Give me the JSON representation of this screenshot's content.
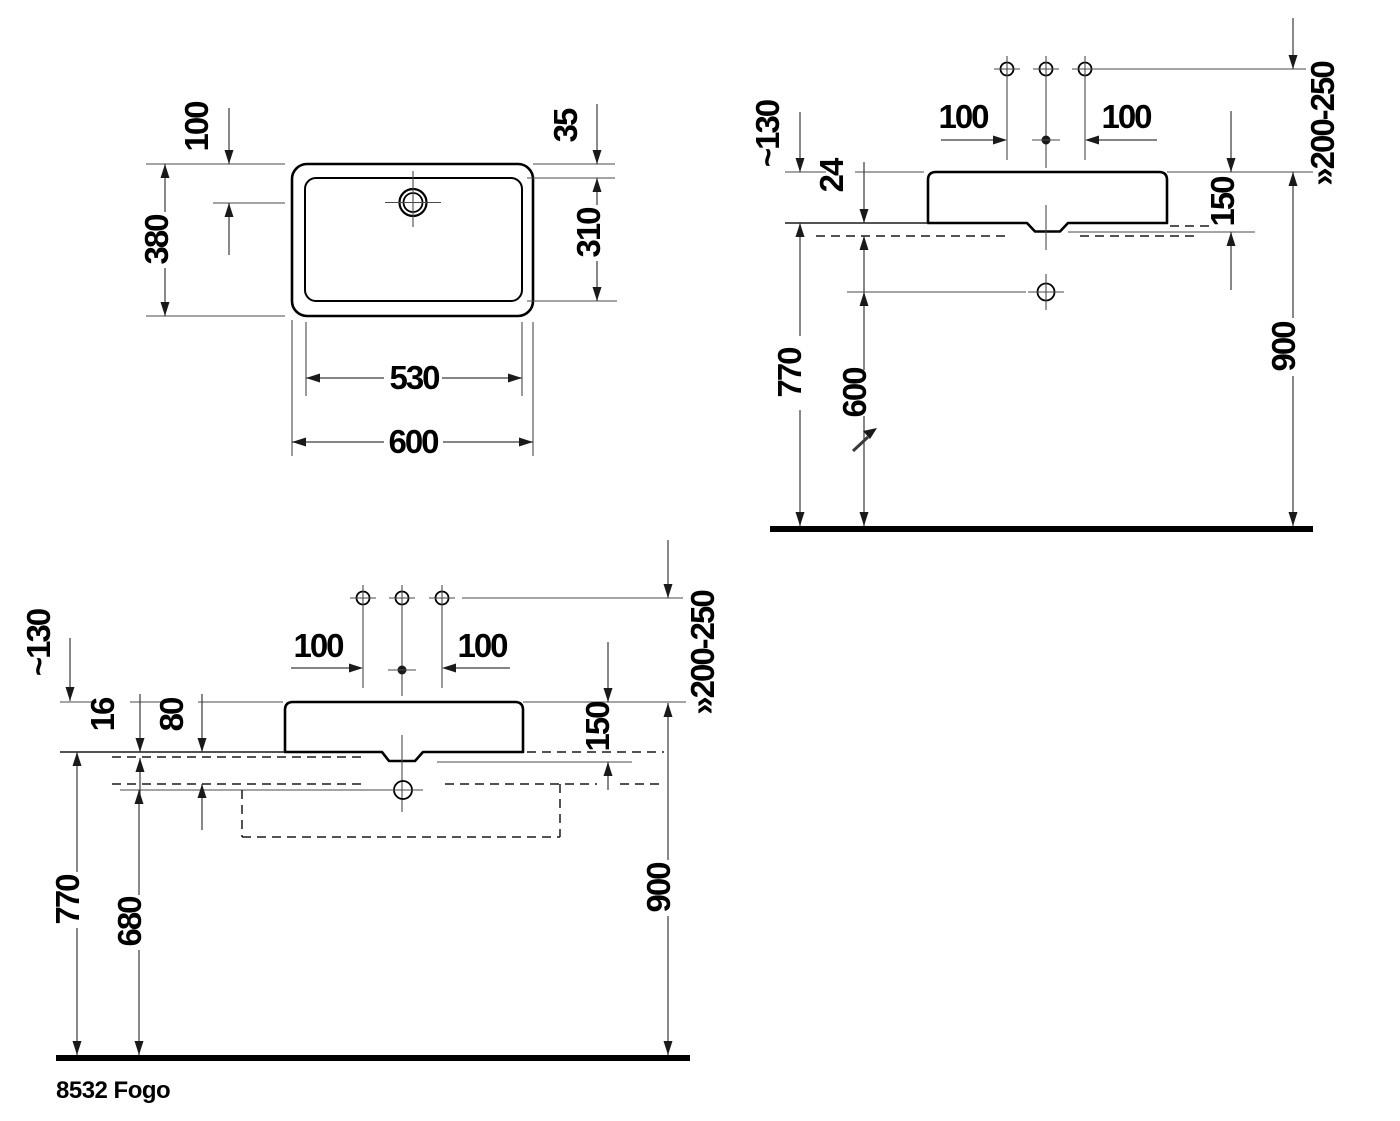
{
  "footer": {
    "model_label": "8532 Fogo"
  },
  "plan_view": {
    "dim_faucet_offset": "100",
    "dim_depth_outer": "380",
    "dim_rim": "35",
    "dim_depth_inner": "310",
    "dim_width_inner": "530",
    "dim_width_outer": "600"
  },
  "side_view": {
    "dim_faucet_height": "~130",
    "dim_counter_thickness": "24",
    "dim_hole_left": "100",
    "dim_hole_right": "100",
    "dim_basin_height": "150",
    "dim_counter_height": "770",
    "dim_drain_height": "600",
    "dim_rim_height": "900",
    "dim_mirror": "»200-250"
  },
  "front_view": {
    "dim_faucet_height": "~130",
    "dim_plate_thickness": "16",
    "dim_console_height": "80",
    "dim_hole_left": "100",
    "dim_hole_right": "100",
    "dim_basin_height": "150",
    "dim_console_top_height": "770",
    "dim_drain_height": "680",
    "dim_rim_height": "900",
    "dim_mirror": "»200-250"
  }
}
